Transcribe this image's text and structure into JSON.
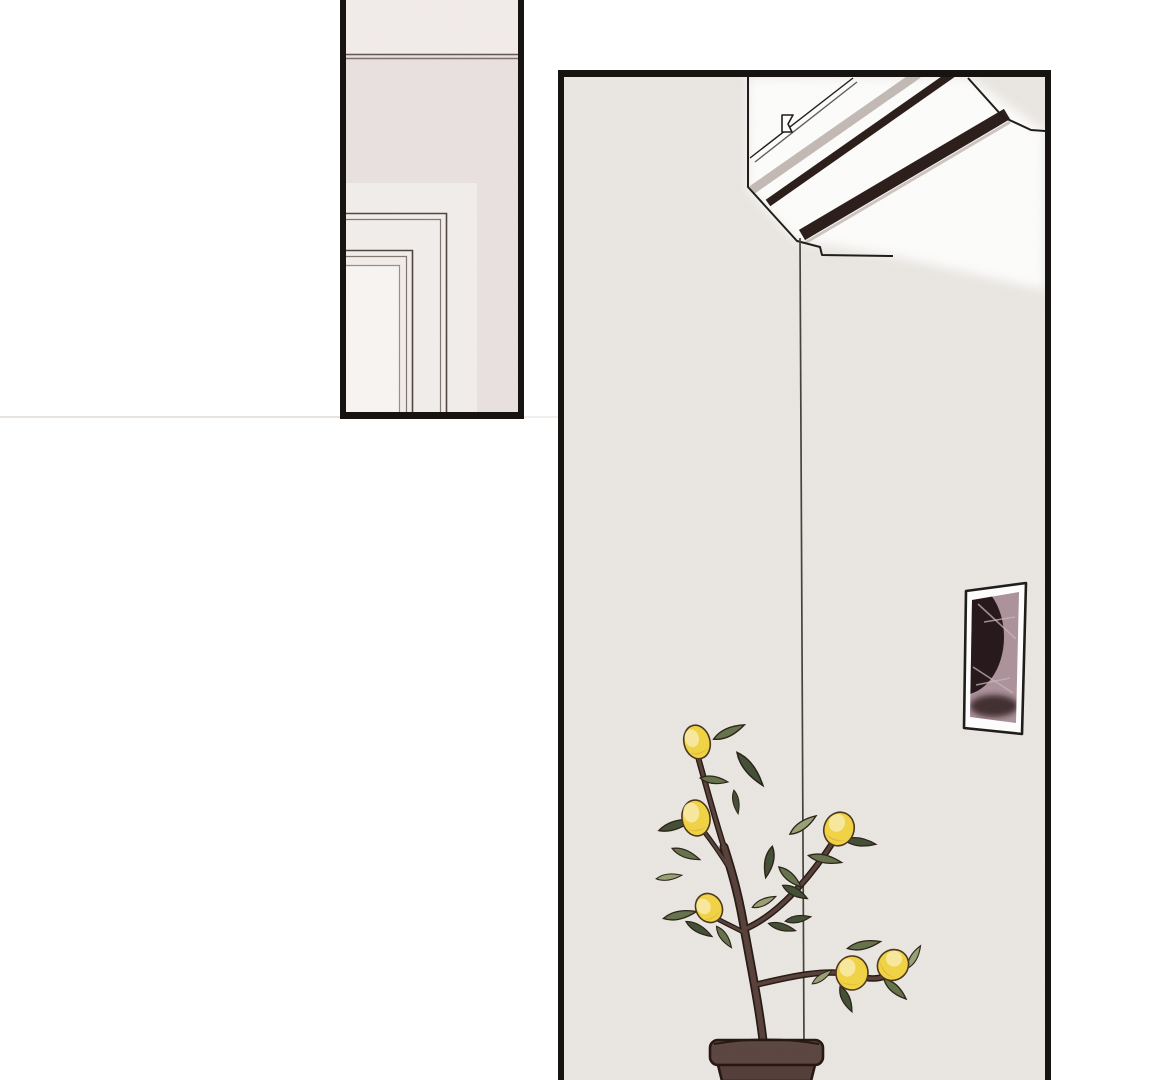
{
  "page": {
    "type": "comic-page",
    "description": "Webtoon/manga page, white background, two black-bordered panels with no dialogue or text.",
    "divider_line": "faint horizontal rule level with the bottom of the left panel"
  },
  "panels": {
    "left": {
      "name": "door-frame-corner-panel",
      "description": "Close-up of an interior corner: ceiling junction line at top, nested door frame moldings below, soft pinkish-grey walls."
    },
    "right": {
      "name": "room-panel",
      "description": "Tall room panel: ceiling-mounted air conditioner at an angle in the top right, a thin cord hanging down to a potted lemon tree, and a framed abstract picture on the wall."
    }
  },
  "objects": {
    "ceiling_line": {
      "label": "ceiling junction double line"
    },
    "door_frame": {
      "label": "nested door frame moldings",
      "nesting_levels": 3
    },
    "air_conditioner": {
      "label": "ceiling air conditioner",
      "vent_slats": 2,
      "accent_stripe": true
    },
    "cord": {
      "label": "thin cord hanging from the air conditioner down to the plant pot"
    },
    "picture_frame": {
      "label": "tilted wall frame with abstract mauve photo"
    },
    "lemon_tree": {
      "label": "potted lemon tree",
      "lemon_count": 6
    },
    "plant_pot": {
      "label": "dark brown flower pot",
      "cropped_at_bottom": true
    }
  },
  "colors": {
    "page-bg": "#ffffff",
    "panel-border": "#171310",
    "faint-line": "#e8e3df",
    "wall-left-top": "#f2eceb",
    "wall-left": "#e9e2e0",
    "wall-left-light": "#f2eeec",
    "door-light": "#f8f5f3",
    "ceiling-line": "#5f5450",
    "molding-dark": "#4f4440",
    "molding-soft": "#82766f",
    "wall-right": "#eae7e3",
    "glow-white": "#fdfdfc",
    "ac-outline": "#1d1a18",
    "ac-stripe": "#c4bab5",
    "ac-slat": "#2a1c18",
    "ac-slat-highlight": "#cfc5c0",
    "cord": "#454038",
    "frame-border": "#1d1a18",
    "frame-matte": "#ffffff",
    "photo-bg": "#ab929b",
    "photo-dark": "#251719",
    "photo-streak": "#c9b4ba",
    "branch": "#57403a",
    "branch-outline": "#261812",
    "leaf-dark": "#414f35",
    "leaf-mid": "#64734b",
    "leaf-light": "#96a175",
    "leaf-outline": "#2c2117",
    "lemon": "#f2d344",
    "lemon-hi": "#f9ecab",
    "lemon-shadow": "#d8a930",
    "lemon-outline": "#4a371a",
    "pot": "#523d38",
    "pot-rim": "#5a4540",
    "pot-outline": "#241511"
  }
}
